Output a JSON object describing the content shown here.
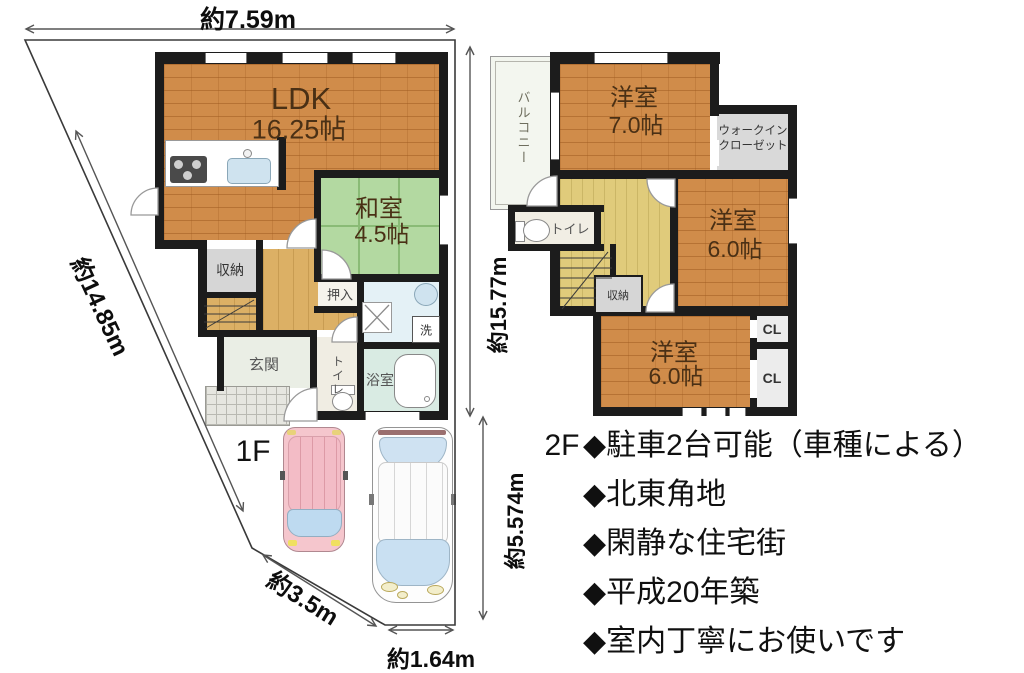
{
  "site": {
    "dim_top": "約7.59m",
    "dim_left": "約14.85m",
    "dim_right": "約15.77m",
    "dim_parking": "約5.574m",
    "dim_bottom_diag": "約3.5m",
    "dim_bottom": "約1.64m"
  },
  "floor1": {
    "label": "1F",
    "ldk": {
      "name": "LDK",
      "size": "16.25帖"
    },
    "washitsu": {
      "name": "和室",
      "size": "4.5帖"
    },
    "storage": "収納",
    "oshiire": "押入",
    "entrance": "玄関",
    "toilet": "トイレ",
    "bath": "浴室",
    "laundry": "洗"
  },
  "floor2": {
    "label": "2F",
    "bedroom1": {
      "name": "洋室",
      "size": "7.0帖"
    },
    "bedroom2": {
      "name": "洋室",
      "size": "6.0帖"
    },
    "bedroom3": {
      "name": "洋室",
      "size": "6.0帖"
    },
    "wic_line1": "ウォークイン",
    "wic_line2": "クローゼット",
    "balcony": "バルコニー",
    "toilet": "トイレ",
    "storage": "収納",
    "closet1": "CL",
    "closet2": "CL"
  },
  "features": {
    "items": [
      "◆駐車2台可能（車種による）",
      "◆北東角地",
      "◆閑静な住宅街",
      "◆平成20年築",
      "◆室内丁寧にお使いです"
    ]
  },
  "colors": {
    "wood": "#d08c4a",
    "tatami": "#b3d9a1",
    "hall_1f": "#dcb065",
    "hall_2f": "#e0cb7b",
    "wall": "#1c1c1c",
    "car_pink": "#f5c6cd",
    "car_glass": "#c9e0f2"
  }
}
